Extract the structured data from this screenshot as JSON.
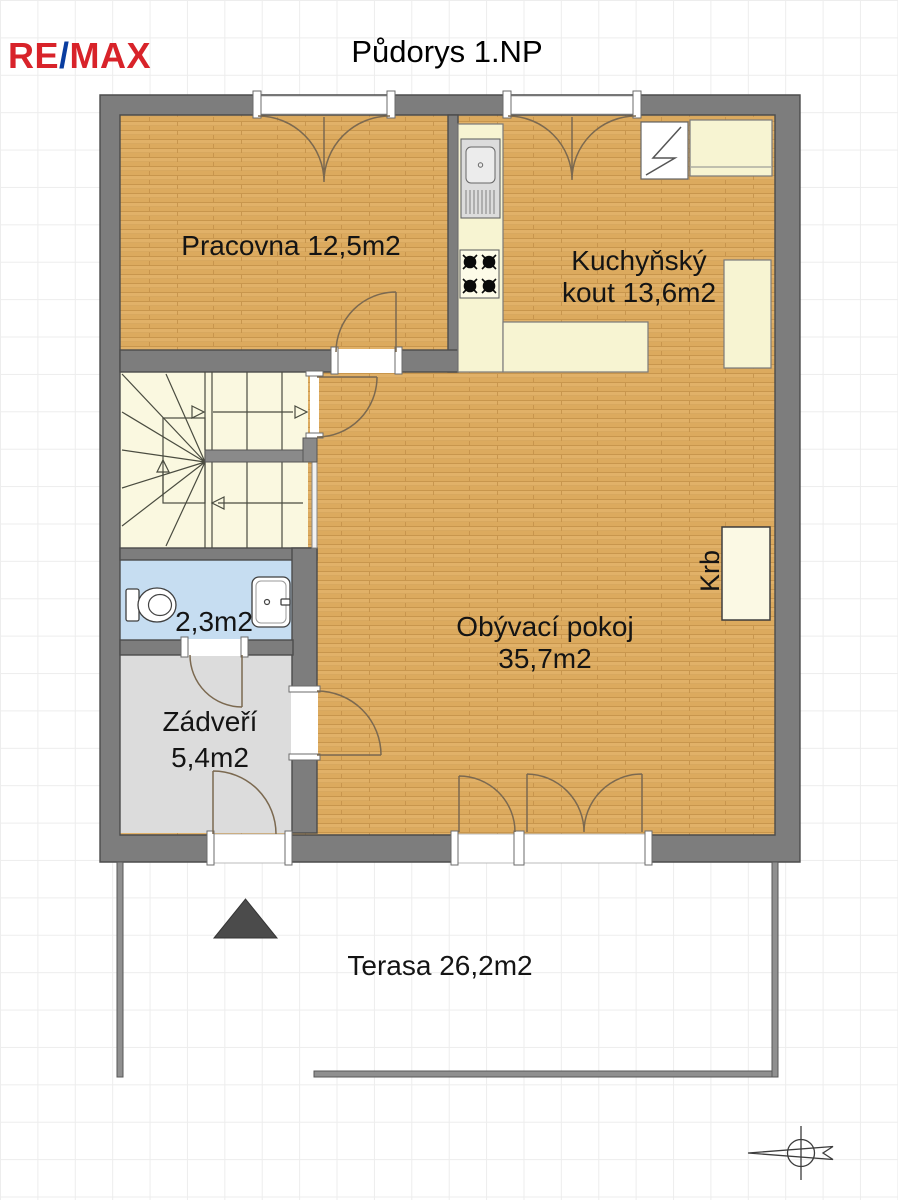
{
  "logo": {
    "re": "RE",
    "slash": "/",
    "max": "MAX"
  },
  "title": "Půdorys 1.NP",
  "rooms": {
    "pracovna": {
      "label": "Pracovna 12,5m2"
    },
    "kuchynsky_kout": {
      "line1": "Kuchyňský",
      "line2": "kout 13,6m2"
    },
    "obyvaci_pokoj": {
      "line1": "Obývací pokoj",
      "line2": "35,7m2"
    },
    "koupelna_wc": {
      "label": "2,3m2"
    },
    "zadveri": {
      "line1": "Zádveří",
      "line2": "5,4m2"
    },
    "krb": {
      "label": "Krb"
    },
    "terasa": {
      "label": "Terasa 26,2m2"
    }
  },
  "colors": {
    "wall": "#7d7d7d",
    "wood_floor": "#e0af64",
    "stairs_floor": "#faf8e0",
    "bathroom_floor": "#c6ddf1",
    "hallway_floor": "#dcdcdc",
    "counter": "#f7f4d2",
    "door_arc": "#7b6950",
    "logo_red": "#d8232a",
    "logo_blue": "#0a3da0"
  }
}
